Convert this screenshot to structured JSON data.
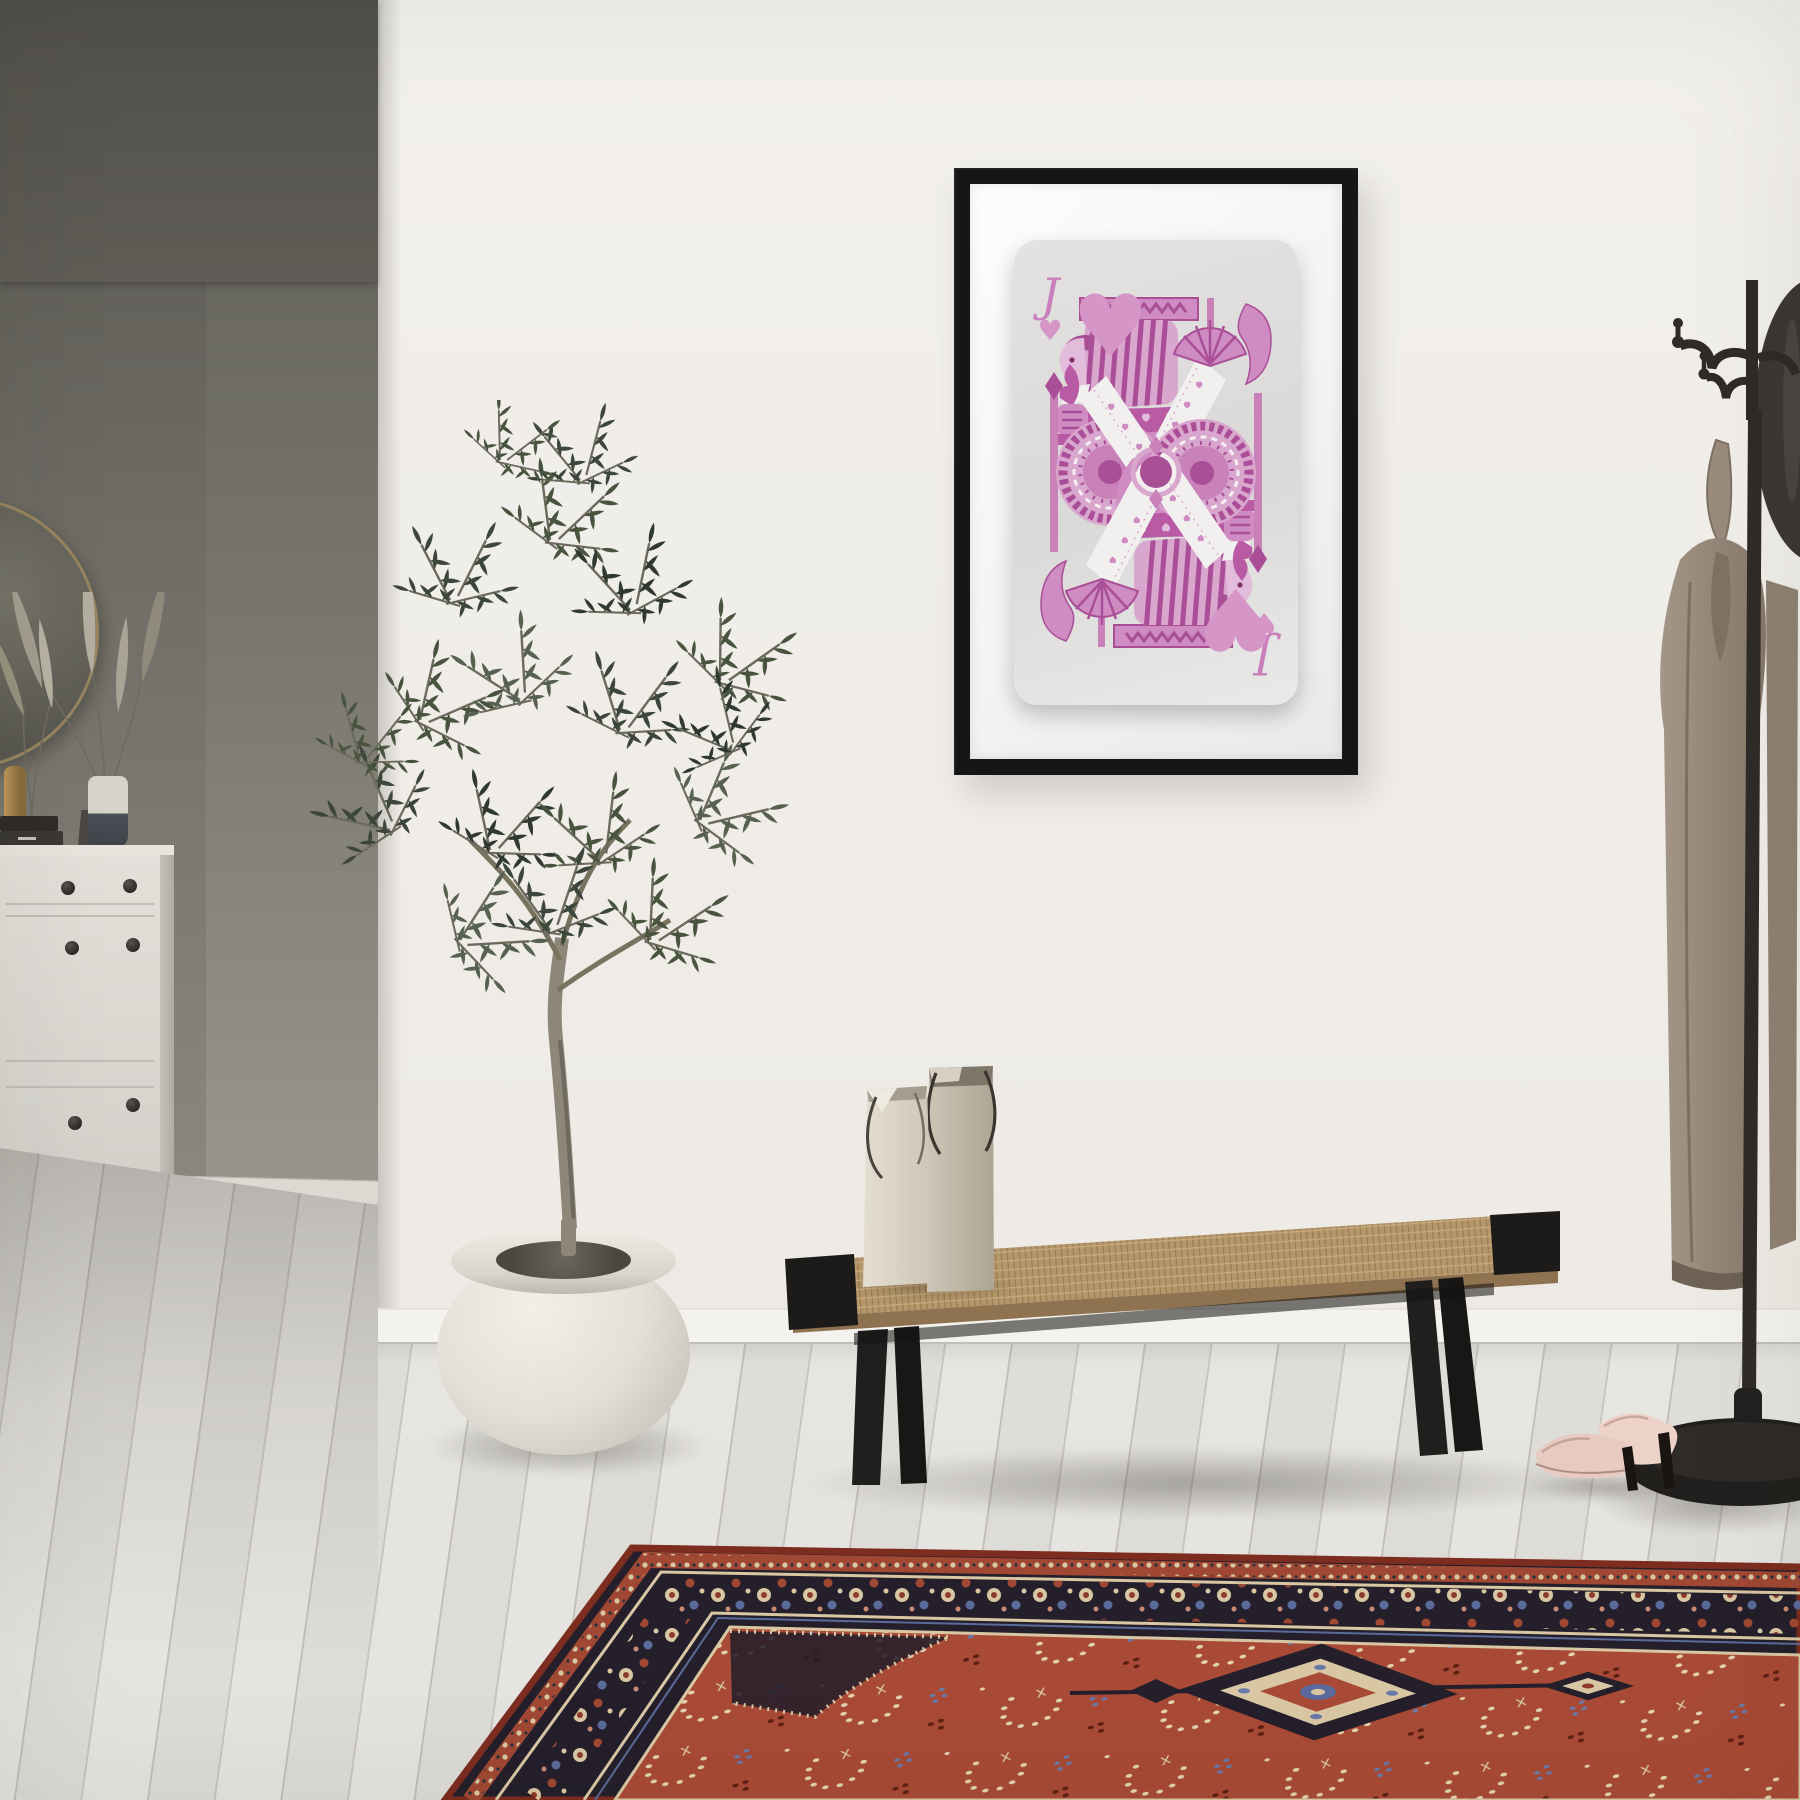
{
  "scene": {
    "type": "interior-photo",
    "description": "Minimal white hallway: framed pink Jack of Hearts poster, olive tree in white planter, white dresser with round mirror and pampas grass, woven black bench with paper shopping bags, black coat stand with beige coat, nude high heels, red persian rug on whitewashed wood floor"
  },
  "poster": {
    "card_rank": "J",
    "suit": "hearts",
    "suit_symbol": "♥"
  },
  "palette": {
    "wall": "#f0ede8",
    "recess_wall": "#6e6c64",
    "floor": "#e7e5e0",
    "frame": "#161616",
    "mat": "#f7f7f5",
    "card_base": "#dddcda",
    "card_pink_light": "#d9a6ce",
    "card_pink_mid": "#cf8cc2",
    "card_pink_deep": "#aa4f97",
    "bench_wood": "#b5976b",
    "bench_frame": "#1d1b19",
    "bag_front": "#ded8cb",
    "bag_back": "#c2baab",
    "coat": "#9a8b7c",
    "coat_stand": "#2e2b28",
    "heels": "#e7cbc1",
    "rug_field": "#a84a36",
    "rug_border": "#241f2a",
    "rug_accent_cream": "#d9c7a4",
    "rug_accent_blue": "#5a6a9a",
    "olive_leaf": "#49543f",
    "planter": "#e9e6df",
    "dresser": "#dfdcd6"
  },
  "objects": [
    "round-mirror",
    "pampas-grass",
    "white-dresser",
    "framed-playing-card-poster",
    "olive-tree",
    "planter-pot",
    "shopping-bags",
    "woven-bench",
    "persian-rug",
    "coat-stand",
    "beige-coat",
    "high-heels"
  ]
}
